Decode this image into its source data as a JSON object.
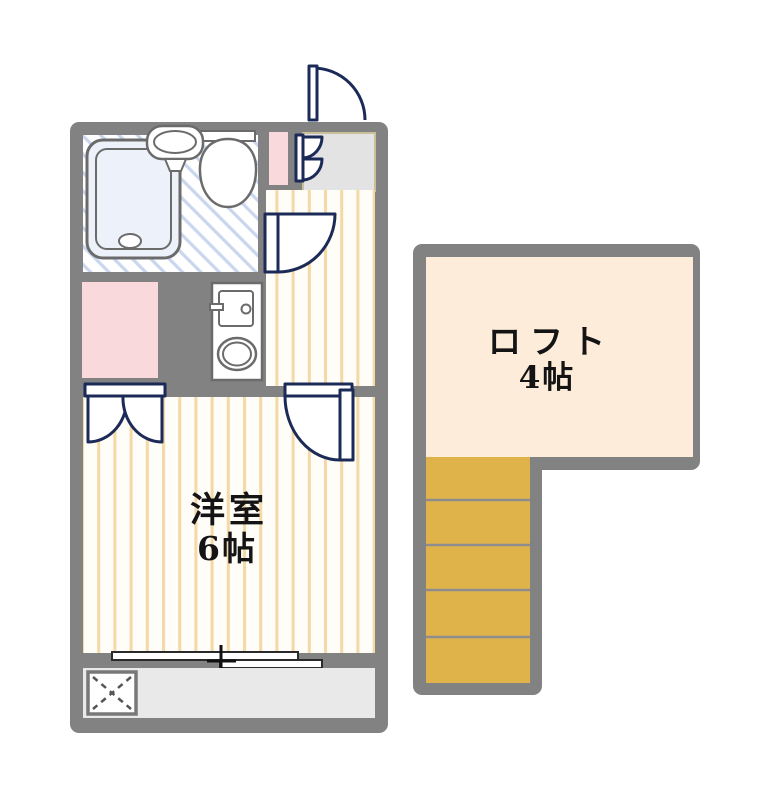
{
  "plan": {
    "type": "apartment-floor-plan",
    "rooms": {
      "main_room": {
        "name_label": "洋室",
        "size_label": "6帖"
      },
      "loft": {
        "name_label": "ロフト",
        "size_label": "4帖"
      }
    },
    "fixtures": [
      "bathtub",
      "wash-basin",
      "toilet",
      "entrance-door",
      "folding-closet-door",
      "shoe-cabinet",
      "genkan-entry",
      "bathroom-door",
      "kitchen-unit",
      "kitchen-sink",
      "single-burner",
      "refrigerator-space",
      "closet-double-doors",
      "room-door",
      "sliding-window",
      "washing-machine-area",
      "balcony",
      "staircase"
    ],
    "colors": {
      "wall": "#828282",
      "floor_bg": "#fffdf7",
      "floor_stripe": "#f4d8a6",
      "bath_hatch": "#c9d6ee",
      "bathtub_fill": "#edf2fa",
      "pink_area": "#fad9dc",
      "genkan_gray": "#e3e3e3",
      "balcony_gray": "#e9e9e9",
      "loft_fill": "#fcecd9",
      "stairs_fill": "#e0b34a",
      "door_navy": "#1c2a57",
      "fixture_outline": "#6b6b6b",
      "text": "#141414"
    },
    "stairs": {
      "visible_steps": 5
    }
  }
}
